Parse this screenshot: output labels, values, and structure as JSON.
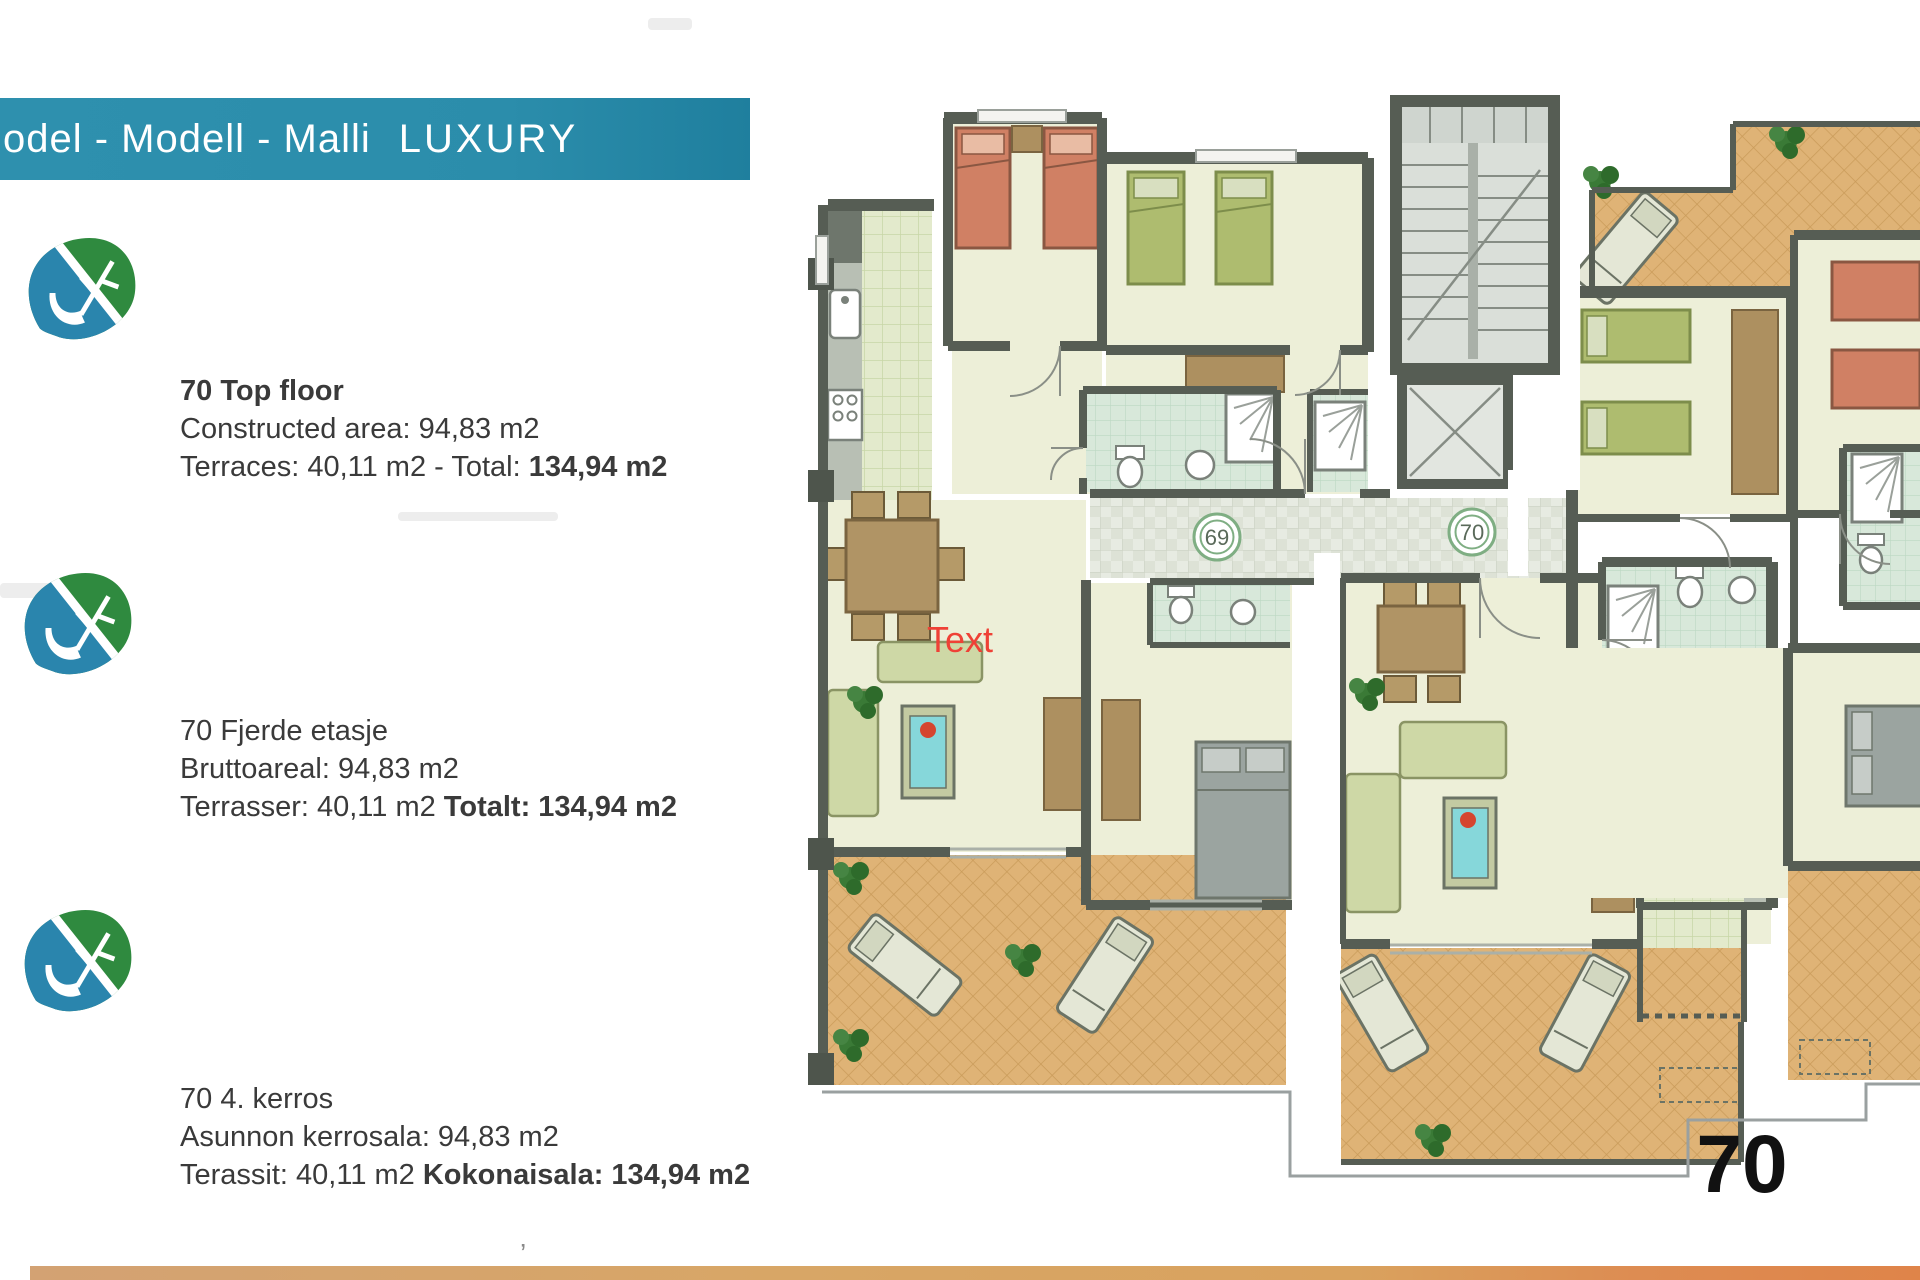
{
  "banner": {
    "brand": "odel - Modell - Malli",
    "label": "LUXURY"
  },
  "info_blocks": [
    {
      "heading": "70 Top floor",
      "line2": "Constructed area: 94,83 m2",
      "line3_normal": "Terraces: 40,11 m2 - Total: ",
      "line3_bold": "134,94 m2"
    },
    {
      "heading": "70 Fjerde etasje",
      "line2": "Bruttoareal: 94,83 m2",
      "line3_normal": "Terrasser: 40,11 m2 ",
      "line3_bold": "Totalt: 134,94 m2"
    },
    {
      "heading": "70 4. kerros",
      "line2": "Asunnon kerrosala: 94,83 m2",
      "line3_normal": "Terassit: 40,11 m2 ",
      "line3_bold": "Kokonaisala: 134,94 m2"
    }
  ],
  "plan": {
    "unit_left_number": "69",
    "unit_right_number": "70",
    "annotation": "Text",
    "big_unit_number": "70",
    "caption": "Top Floor - Fjerde etasje - 4. kerros"
  },
  "colors": {
    "banner_teal": "#2b8dab",
    "leaf_green": "#2f8a3f",
    "leaf_blue": "#2a85ad",
    "wall": "#565d54",
    "floor": "#edefd8",
    "terrace": "#dfb376",
    "kitchen_tile": "#e3eacc",
    "bath_tile": "#d8e8da",
    "bed_green": "#aebc6f",
    "bed_salmon": "#d08064",
    "sofa": "#ced8a6",
    "wood": "#ad9060",
    "pool": "#86d7da",
    "annotation_red": "#ef4136",
    "highlight_outline": "#ffffff",
    "footer_strip": "#d9a25e"
  },
  "stray_mark": "’"
}
